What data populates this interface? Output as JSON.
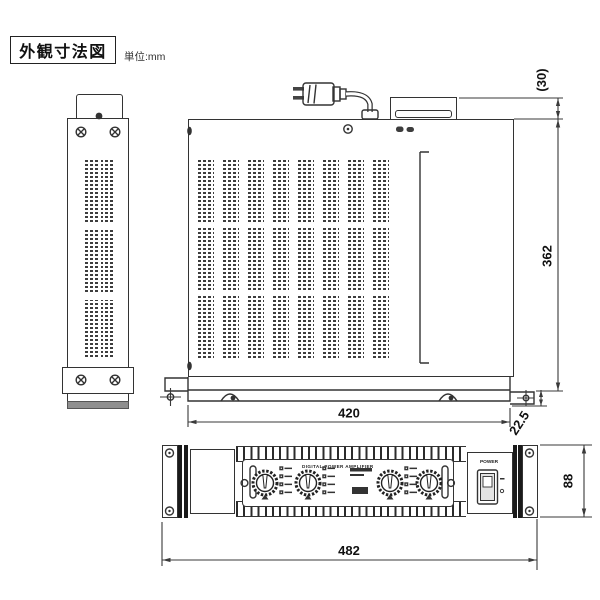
{
  "title": {
    "label": "外観寸法図",
    "unit_label": "単位:mm"
  },
  "dimensions": {
    "rear_projection": "(30)",
    "depth": "362",
    "body_width": "420",
    "front_projection": "22.5",
    "panel_height": "88",
    "panel_width": "482"
  },
  "front_panel": {
    "model_text": "DIGITAL POWER AMPLIFIER",
    "power_label": "POWER"
  },
  "colors": {
    "line": "#333333",
    "dark_bar": "#1a1a1a",
    "vent": "#3d3d3d",
    "shade": "#8f8f8f",
    "background": "#ffffff"
  }
}
